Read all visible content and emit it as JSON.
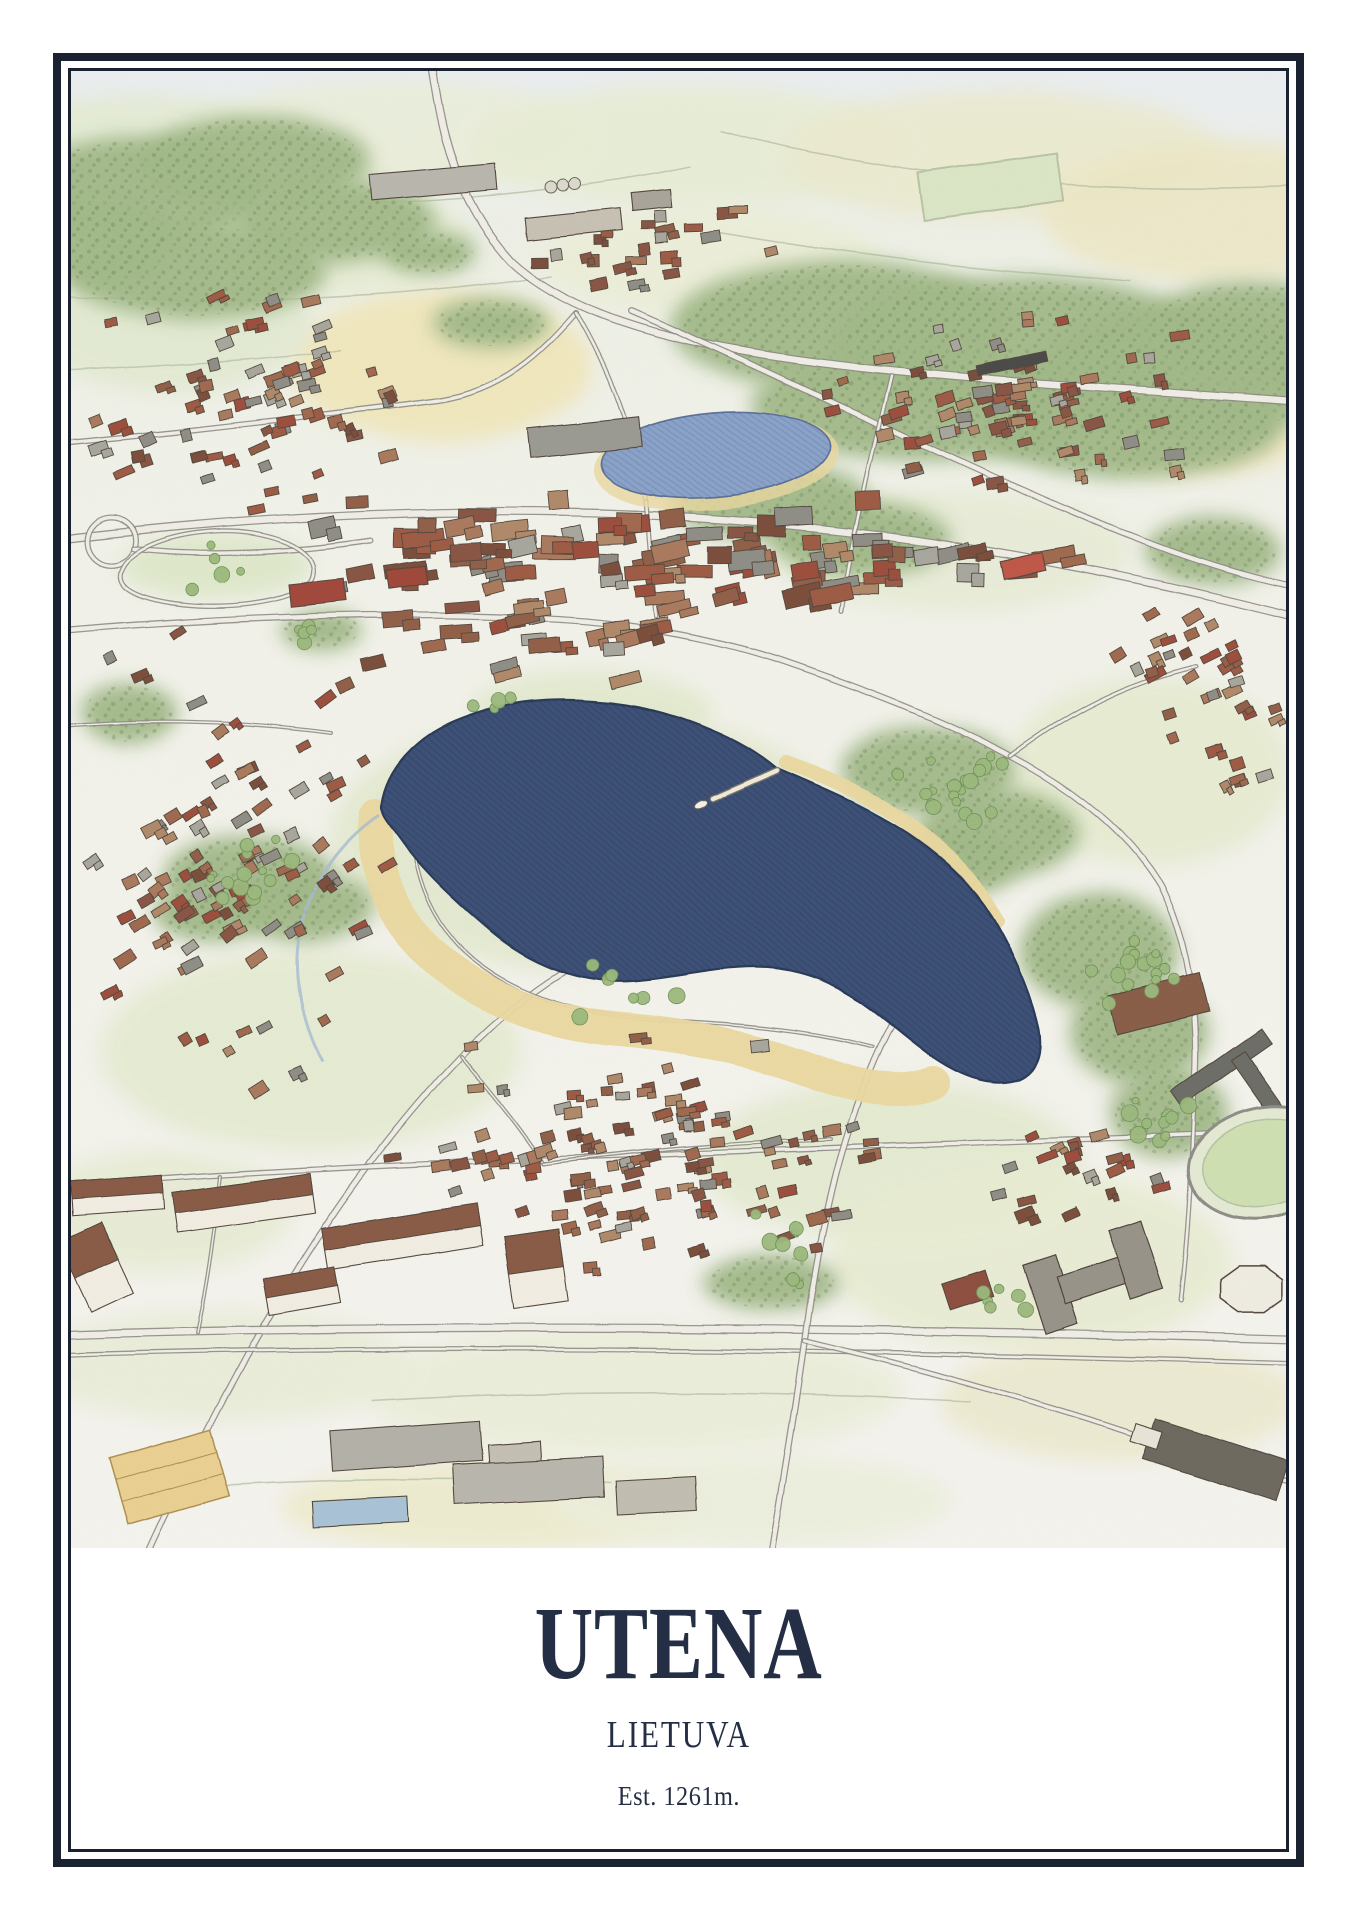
{
  "poster": {
    "title": "UTENA",
    "subtitle": "LIETUVA",
    "caption": "Est. 1261m.",
    "colors": {
      "frame": "#1a2231",
      "text": "#242e44",
      "paper": "#ffffff",
      "illustration_bg_top": "#eaeef0",
      "illustration_bg": "#f2f2ea",
      "lake": "#3e5176",
      "lake_outline": "#2c3b59",
      "pond": "#8ba3c9",
      "sand": "#ead8a0",
      "forest": "#a2b989",
      "tree": "#9cba7e",
      "tree_edge": "#6e9156",
      "road_fill": "#efede6",
      "road_edge": "#8f8e86",
      "field_contour": "#bcc5ae",
      "roof_brown": "#92604a",
      "wall_light": "#f2ede2",
      "outline_ink": "#55493f"
    },
    "illustration": {
      "seed": 42,
      "fields": [
        [
          60,
          85,
          170,
          60,
          "#e4ebd3"
        ],
        [
          320,
          65,
          200,
          55,
          "#eaeeda"
        ],
        [
          620,
          75,
          220,
          60,
          "#e8edd5"
        ],
        [
          930,
          85,
          220,
          65,
          "#ebead0"
        ],
        [
          1140,
          140,
          170,
          70,
          "#ece7c6"
        ],
        [
          1120,
          320,
          150,
          85,
          "#efe6c0"
        ],
        [
          370,
          295,
          150,
          75,
          "#f0e6ba"
        ],
        [
          640,
          190,
          170,
          55,
          "#ebeed8"
        ],
        [
          100,
          255,
          140,
          65,
          "#e2e9d1"
        ],
        [
          250,
          170,
          150,
          55,
          "#e6ecd4"
        ],
        [
          880,
          480,
          180,
          60,
          "#e7ecd6"
        ],
        [
          1080,
          700,
          140,
          95,
          "#e6ebd1"
        ],
        [
          520,
          770,
          260,
          130,
          "#e3e9cf"
        ],
        [
          240,
          980,
          210,
          100,
          "#e5ebd1"
        ],
        [
          820,
          1090,
          190,
          80,
          "#e4ead0"
        ],
        [
          960,
          1190,
          200,
          90,
          "#e8ecd2"
        ],
        [
          560,
          1320,
          270,
          65,
          "#ebeeda"
        ],
        [
          150,
          1295,
          190,
          55,
          "#e9edd8"
        ],
        [
          420,
          1435,
          210,
          45,
          "#eeebcd"
        ],
        [
          1050,
          1330,
          180,
          60,
          "#ece9cf"
        ],
        [
          680,
          1430,
          200,
          45,
          "#ecefdc"
        ],
        [
          90,
          1140,
          130,
          60,
          "#e7ecd4"
        ],
        [
          145,
          495,
          95,
          32,
          "#dde7c8"
        ],
        [
          520,
          640,
          120,
          40,
          "#e2e9cd"
        ]
      ],
      "contours": [
        "M -10,120 C 200,145 420,135 620,95",
        "M 650,60 C 800,100 1000,125 1220,115",
        "M -10,225 C 150,235 320,228 480,205",
        "M 640,160 C 780,185 920,200 1060,210",
        "M -10,300 C 90,295 180,290 270,280",
        "M 300,1330 C 500,1318 700,1320 900,1330",
        "M 60,1420 C 220,1408 380,1405 540,1412"
      ],
      "forests": [
        [
          70,
          120,
          125,
          55
        ],
        [
          185,
          90,
          115,
          45
        ],
        [
          265,
          150,
          100,
          42
        ],
        [
          125,
          200,
          130,
          48
        ],
        [
          20,
          170,
          80,
          40
        ],
        [
          770,
          255,
          170,
          65
        ],
        [
          950,
          275,
          190,
          70
        ],
        [
          1120,
          305,
          160,
          60
        ],
        [
          860,
          335,
          180,
          55
        ],
        [
          1060,
          355,
          150,
          52
        ],
        [
          1180,
          260,
          110,
          50
        ],
        [
          700,
          430,
          100,
          40
        ],
        [
          790,
          468,
          90,
          38
        ],
        [
          858,
          700,
          88,
          45
        ],
        [
          928,
          762,
          80,
          45
        ],
        [
          878,
          792,
          70,
          36
        ],
        [
          1028,
          880,
          80,
          58
        ],
        [
          1068,
          962,
          70,
          52
        ],
        [
          1098,
          1042,
          60,
          45
        ],
        [
          178,
          806,
          85,
          42
        ],
        [
          232,
          836,
          70,
          35
        ],
        [
          140,
          842,
          58,
          30
        ],
        [
          420,
          252,
          58,
          25
        ],
        [
          58,
          642,
          48,
          30
        ],
        [
          700,
          1212,
          68,
          28
        ],
        [
          1142,
          480,
          68,
          34
        ],
        [
          358,
          182,
          48,
          22
        ],
        [
          250,
          560,
          40,
          20
        ]
      ],
      "roads": [
        {
          "d": "M 360,-10 C 370,60 385,130 440,190 C 510,255 640,280 800,298 C 950,313 1060,318 1220,330",
          "w": 9
        },
        {
          "d": "M 560,240 C 700,300 860,380 1000,440 C 1080,475 1150,500 1220,515",
          "w": 7
        },
        {
          "d": "M -10,372 C 120,360 240,345 360,330 C 432,322 472,280 505,242",
          "w": 6
        },
        {
          "d": "M -10,468 C 180,445 420,432 640,448 C 860,462 1040,500 1220,545",
          "w": 9
        },
        {
          "d": "M -10,560 C 160,545 330,540 480,548 C 560,552 645,568 705,588 C 790,617 865,645 940,685 C 1010,722 1060,765 1090,815 C 1118,872 1128,940 1124,1012",
          "w": 7
        },
        {
          "d": "M 75,1487 C 160,1300 260,1120 390,985 C 470,903 552,860 642,843 C 722,830 782,830 845,842",
          "w": 7
        },
        {
          "d": "M -10,1115 C 300,1090 700,1080 1220,1060",
          "w": 6
        },
        {
          "d": "M -10,1264 C 300,1254 700,1254 1220,1268",
          "w": 9
        },
        {
          "d": "M -10,1284 C 300,1274 700,1276 1220,1292",
          "w": 5
        },
        {
          "d": "M 700,1487 C 716,1390 726,1330 734,1270 C 746,1180 762,1098 792,1018 C 822,938 862,878 922,840",
          "w": 7
        },
        {
          "d": "M 734,1270 C 850,1298 960,1328 1080,1368 C 1140,1388 1180,1402 1220,1412",
          "w": 6
        },
        {
          "d": "M 390,985 C 424,1026 452,1060 472,1092",
          "w": 4
        },
        {
          "d": "M 40,470 m -24,0 a 24,24 0 1 0 48,0 a 24,24 0 1 0 -48,0",
          "w": 6
        },
        {
          "d": "M 62,478 C 140,486 220,482 300,470",
          "w": 6
        },
        {
          "d": "M 350,700 C 332,760 342,828 392,880 C 444,928 520,946 600,950 C 680,954 742,960 802,976",
          "w": 4
        },
        {
          "d": "M 505,242 C 540,300 560,360 575,430",
          "w": 5
        },
        {
          "d": "M 575,430 C 580,490 582,520 585,545",
          "w": 5
        },
        {
          "d": "M 820,305 C 800,390 780,470 770,540",
          "w": 5
        },
        {
          "d": "M 940,685 C 1000,640 1060,610 1125,595",
          "w": 5
        },
        {
          "d": "M 1124,1012 C 1122,1090 1118,1160 1110,1230",
          "w": 5
        },
        {
          "d": "M -10,655 C 80,648 170,650 260,662",
          "w": 4
        },
        {
          "d": "M 150,1105 C 140,1190 132,1230 126,1262",
          "w": 4
        },
        {
          "d": "M 472,1092 C 560,1080 660,1072 760,1068",
          "w": 4
        },
        {
          "d": "M 50,500 C 60,470 130,455 180,462 C 230,470 250,490 240,510 C 225,532 150,540 100,532 C 65,526 45,516 50,500 Z",
          "w": 5
        }
      ],
      "sand": [
        {
          "d": "M 305,745 C 300,800 320,850 368,890 C 420,932 480,952 548,958 C 620,964 690,980 748,1002 C 790,1018 830,1024 862,1012",
          "w": 34
        },
        {
          "d": "M 715,692 C 760,708 800,726 842,756 C 880,784 906,814 926,850",
          "w": 14
        }
      ],
      "stream": "M 308,744 C 270,770 240,810 230,860 C 222,900 230,950 252,990",
      "lake": {
        "path": "M 311,733 C 316,700 342,666 390,648 C 432,632 472,626 522,630 C 565,633 600,642 638,658 C 672,672 692,686 706,698 C 748,716 792,734 836,762 C 878,790 908,822 928,858 C 948,894 962,930 968,958 C 972,982 966,1000 948,1008 C 924,1016 896,1008 868,990 C 840,972 812,944 780,924 C 748,904 716,896 684,896 C 640,896 600,908 560,910 C 512,913 462,895 422,862 C 386,832 352,800 332,772 C 318,752 308,744 311,733 Z"
      },
      "pond": {
        "cx": 644,
        "cy": 384,
        "rx": 115,
        "ry": 42,
        "rot": -5
      },
      "pier": {
        "x1": 706,
        "y1": 700,
        "x2": 642,
        "y2": 728
      },
      "boat": {
        "cx": 630,
        "cy": 734
      },
      "exclusions": [
        [
          600,
          770,
          295,
          132,
          10
        ],
        [
          880,
          915,
          125,
          100,
          0
        ],
        [
          644,
          384,
          140,
          58,
          -5
        ],
        [
          1195,
          1092,
          100,
          75,
          -12
        ],
        [
          1020,
          1210,
          100,
          62,
          -18
        ]
      ],
      "roof_palette": [
        "#92604a",
        "#8a5744",
        "#a06a50",
        "#ab7a5e",
        "#7c4f3e",
        "#9e5b45",
        "#8f8f87",
        "#a8a79e",
        "#b08a6a",
        "#9d4f3e"
      ],
      "clusters": [
        {
          "name": "nw-loops",
          "cx": 185,
          "cy": 330,
          "sx": 175,
          "sy": 125,
          "n": 70,
          "rot": -18,
          "w": [
            9,
            20
          ],
          "h": [
            7,
            12
          ]
        },
        {
          "name": "ne-grid",
          "cx": 940,
          "cy": 330,
          "sx": 215,
          "sy": 95,
          "n": 75,
          "rot": -12,
          "w": [
            9,
            20
          ],
          "h": [
            7,
            12
          ]
        },
        {
          "name": "n-strip",
          "cx": 590,
          "cy": 175,
          "sx": 160,
          "sy": 45,
          "n": 22,
          "rot": -8,
          "w": [
            10,
            22
          ],
          "h": [
            7,
            12
          ]
        },
        {
          "name": "center-commercial",
          "cx": 600,
          "cy": 478,
          "sx": 430,
          "sy": 55,
          "n": 85,
          "rot": -6,
          "w": [
            16,
            44
          ],
          "h": [
            10,
            20
          ]
        },
        {
          "name": "mid-blocks",
          "cx": 480,
          "cy": 560,
          "sx": 200,
          "sy": 60,
          "n": 30,
          "rot": -10,
          "w": [
            16,
            34
          ],
          "h": [
            10,
            16
          ]
        },
        {
          "name": "w-residential",
          "cx": 165,
          "cy": 780,
          "sx": 155,
          "sy": 250,
          "n": 95,
          "rot": -30,
          "w": [
            9,
            20
          ],
          "h": [
            7,
            12
          ]
        },
        {
          "name": "s-residential",
          "cx": 555,
          "cy": 1085,
          "sx": 285,
          "sy": 125,
          "n": 115,
          "rot": -12,
          "w": [
            9,
            20
          ],
          "h": [
            7,
            12
          ]
        },
        {
          "name": "se-cluster",
          "cx": 1000,
          "cy": 1105,
          "sx": 95,
          "sy": 50,
          "n": 20,
          "rot": -18,
          "w": [
            9,
            20
          ],
          "h": [
            7,
            12
          ]
        },
        {
          "name": "ne-far",
          "cx": 1120,
          "cy": 585,
          "sx": 85,
          "sy": 75,
          "n": 20,
          "rot": -25,
          "w": [
            9,
            20
          ],
          "h": [
            7,
            12
          ]
        },
        {
          "name": "e-mid",
          "cx": 1150,
          "cy": 660,
          "sx": 70,
          "sy": 80,
          "n": 16,
          "rot": -25,
          "w": [
            9,
            18
          ],
          "h": [
            7,
            11
          ]
        }
      ],
      "landmarks": [
        {
          "t": "rect",
          "x": 300,
          "y": 98,
          "w": 125,
          "h": 26,
          "r": -5,
          "c": "#b9b7ae"
        },
        {
          "t": "rect",
          "x": 455,
          "y": 142,
          "w": 95,
          "h": 22,
          "r": -6,
          "c": "#c8c2b4"
        },
        {
          "t": "silo",
          "x": 480,
          "y": 116
        },
        {
          "t": "rect",
          "x": 560,
          "y": 120,
          "w": 40,
          "h": 18,
          "r": -6,
          "c": "#a9a59a"
        },
        {
          "t": "pitch",
          "x": 850,
          "y": 92,
          "w": 140,
          "h": 48,
          "r": -8
        },
        {
          "t": "train",
          "x": 905,
          "y": 288,
          "w": 70,
          "h": 10,
          "r": -12
        },
        {
          "t": "rect",
          "x": 930,
          "y": 486,
          "w": 44,
          "h": 18,
          "r": -12,
          "c": "#c05848"
        },
        {
          "t": "rect",
          "x": 219,
          "y": 511,
          "w": 55,
          "h": 22,
          "r": -6,
          "c": "#a34a3c"
        },
        {
          "t": "rect",
          "x": 316,
          "y": 497,
          "w": 40,
          "h": 18,
          "r": -8,
          "c": "#a04a3a"
        },
        {
          "t": "rect",
          "x": 458,
          "y": 352,
          "w": 111,
          "h": 30,
          "r": -6,
          "c": "#9b9b93"
        },
        {
          "t": "apt",
          "x": 0,
          "y": 1108,
          "w": 92,
          "h": 34,
          "r": -4
        },
        {
          "t": "apt",
          "x": 103,
          "y": 1112,
          "w": 140,
          "h": 40,
          "r": -8
        },
        {
          "t": "apt",
          "x": 253,
          "y": 1145,
          "w": 157,
          "h": 42,
          "r": -9
        },
        {
          "t": "apt",
          "x": 438,
          "y": 1162,
          "w": 55,
          "h": 72,
          "r": -8
        },
        {
          "t": "apt",
          "x": 2,
          "y": 1158,
          "w": 46,
          "h": 76,
          "r": -25
        },
        {
          "t": "apt",
          "x": 195,
          "y": 1202,
          "w": 72,
          "h": 36,
          "r": -10
        },
        {
          "t": "rect",
          "x": 260,
          "y": 1355,
          "w": 150,
          "h": 40,
          "r": -4,
          "c": "#b3b1a8"
        },
        {
          "t": "rect",
          "x": 418,
          "y": 1372,
          "w": 52,
          "h": 46,
          "r": -4,
          "c": "#c4c0b4"
        },
        {
          "t": "rect",
          "x": 242,
          "y": 1428,
          "w": 95,
          "h": 26,
          "r": -3,
          "c": "#a9c3d6"
        },
        {
          "t": "rect",
          "x": 382,
          "y": 1390,
          "w": 150,
          "h": 40,
          "r": -3,
          "c": "#b9b7ae"
        },
        {
          "t": "rect",
          "x": 545,
          "y": 1408,
          "w": 80,
          "h": 34,
          "r": -3,
          "c": "#c2beb2"
        },
        {
          "t": "court",
          "x": 46,
          "y": 1372,
          "w": 105,
          "h": 68,
          "r": -16
        },
        {
          "t": "rect",
          "x": 1040,
          "y": 912,
          "w": 95,
          "h": 40,
          "r": -14,
          "c": "#8a5f49"
        },
        {
          "t": "rect",
          "x": 1095,
          "y": 988,
          "w": 110,
          "h": 18,
          "r": -35,
          "c": "#6e6e68"
        },
        {
          "t": "rect",
          "x": 1150,
          "y": 1010,
          "w": 80,
          "h": 16,
          "r": 55,
          "c": "#6e6e68"
        },
        {
          "t": "hshape",
          "x": 1020,
          "y": 1210,
          "r": -18
        },
        {
          "t": "oct",
          "x": 1180,
          "y": 1218,
          "s": 34
        },
        {
          "t": "stadium",
          "x": 1195,
          "y": 1092,
          "rx": 78,
          "ry": 55,
          "r": -12
        },
        {
          "t": "rect",
          "x": 875,
          "y": 1205,
          "w": 45,
          "h": 28,
          "r": -18,
          "c": "#8e4f3f"
        },
        {
          "t": "rect",
          "x": 1075,
          "y": 1368,
          "w": 140,
          "h": 42,
          "r": 18,
          "c": "#6e6a60"
        },
        {
          "t": "rect",
          "x": 1062,
          "y": 1356,
          "w": 28,
          "h": 18,
          "r": 18,
          "c": "#e8e4d8"
        }
      ],
      "trees": [
        {
          "x": 180,
          "y": 800,
          "n": 14,
          "s": 55
        },
        {
          "x": 880,
          "y": 720,
          "n": 22,
          "s": 75
        },
        {
          "x": 1060,
          "y": 900,
          "n": 16,
          "s": 60
        },
        {
          "x": 1090,
          "y": 1050,
          "n": 10,
          "s": 45
        },
        {
          "x": 420,
          "y": 640,
          "n": 6,
          "s": 40
        },
        {
          "x": 700,
          "y": 1180,
          "n": 8,
          "s": 60
        },
        {
          "x": 240,
          "y": 560,
          "n": 5,
          "s": 35
        },
        {
          "x": 950,
          "y": 1230,
          "n": 6,
          "s": 45
        },
        {
          "x": 560,
          "y": 920,
          "n": 8,
          "s": 70
        },
        {
          "x": 140,
          "y": 490,
          "n": 5,
          "s": 45
        }
      ]
    }
  }
}
